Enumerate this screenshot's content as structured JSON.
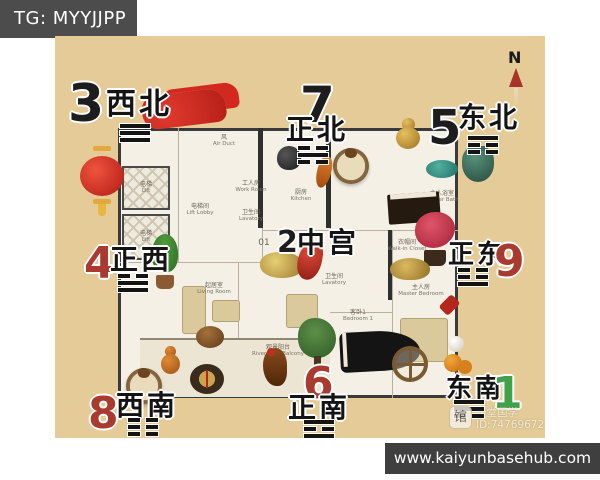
{
  "header": {
    "tag_label": "TG: MYYJJPP"
  },
  "footer": {
    "url": "www.kaiyunbasehub.com"
  },
  "watermark": {
    "icon_glyph": "馆",
    "brand": "一堂国学",
    "id": "ID:74769672"
  },
  "compass": {
    "label": "N"
  },
  "colors": {
    "background_tan": "#e5cb97",
    "banner_dark": "#4c4c4c",
    "number_black": "#1d1d1d",
    "number_red": "#a93a30",
    "number_green": "#3fa24b",
    "compass_red": "#a83226"
  },
  "sectors": {
    "nw": {
      "number": "3",
      "direction": "西北",
      "trigram_glyph": "☰",
      "trigram_lines": [
        "solid",
        "solid",
        "solid"
      ]
    },
    "n": {
      "number": "7",
      "direction": "正北",
      "trigram_glyph": "☵",
      "trigram_lines": [
        "broken",
        "solid",
        "broken"
      ]
    },
    "ne": {
      "number": "5",
      "direction": "东北",
      "trigram_glyph": "☶",
      "trigram_lines": [
        "solid",
        "broken",
        "broken"
      ]
    },
    "w": {
      "number": "4",
      "direction": "正西",
      "trigram_glyph": "☱",
      "trigram_lines": [
        "broken",
        "solid",
        "solid"
      ]
    },
    "center": {
      "number": "2",
      "direction": "中宫",
      "trigram_glyph": "",
      "trigram_lines": []
    },
    "e": {
      "number": "9",
      "direction": "正东",
      "trigram_glyph": "☳",
      "trigram_lines": [
        "broken",
        "broken",
        "solid"
      ]
    },
    "sw": {
      "number": "8",
      "direction": "西南",
      "trigram_glyph": "☷",
      "trigram_lines": [
        "broken",
        "broken",
        "broken"
      ]
    },
    "s": {
      "number": "6",
      "direction": "正南",
      "trigram_glyph": "☲",
      "trigram_lines": [
        "solid",
        "broken",
        "solid"
      ]
    },
    "se": {
      "number": "1",
      "direction": "东南",
      "trigram_glyph": "☴",
      "trigram_lines": [
        "solid",
        "solid",
        "broken"
      ]
    }
  },
  "floorplan": {
    "unit_number": "01",
    "rooms": {
      "air_duct": {
        "cn": "风",
        "en": "Air Duct"
      },
      "lift1": {
        "cn": "电梯",
        "en": "Lift"
      },
      "lift2": {
        "cn": "电梯",
        "en": "Lift"
      },
      "lift_lobby": {
        "cn": "电梯间",
        "en": "Lift Lobby"
      },
      "work_room": {
        "cn": "工人房",
        "en": "Work Room"
      },
      "lavatory1": {
        "cn": "卫生间",
        "en": "Lavatory"
      },
      "kitchen": {
        "cn": "厨房",
        "en": "Kitchen"
      },
      "bedroom2": {
        "cn": "客卧2",
        "en": "Bedroom 2"
      },
      "master_bath": {
        "cn": "主人浴室",
        "en": "Master Bath"
      },
      "dining": {
        "cn": "餐厅",
        "en": "Dining"
      },
      "lavatory2": {
        "cn": "卫生间",
        "en": "Lavatory"
      },
      "walk_in": {
        "cn": "衣帽间",
        "en": "Walk-in Closet"
      },
      "living": {
        "cn": "起居室",
        "en": "Living Room"
      },
      "bedroom1": {
        "cn": "客卧1",
        "en": "Bedroom 1"
      },
      "master_bedroom": {
        "cn": "主人房",
        "en": "Master Bedroom"
      },
      "balcony": {
        "cn": "观景阳台",
        "en": "River-view Balcony"
      }
    }
  },
  "decor_icons": [
    "red-silk-cloth-icon",
    "red-lantern-icon",
    "potted-plant-icon",
    "horse-plate-icon",
    "black-teapot-icon",
    "orange-koi-icon",
    "golden-gourd-icon",
    "upright-piano-icon",
    "jade-ornament-icon",
    "bronze-pot-icon",
    "red-bonsai-icon",
    "gold-ingots-icon",
    "red-dragon-icon",
    "golden-toad-icon",
    "red-knot-icon",
    "green-tree-icon",
    "grand-piano-icon",
    "rooster-icon",
    "horse-plate-2-icon",
    "orange-gourd-icon",
    "luopan-compass-icon",
    "brown-pot-icon",
    "dharma-wheel-icon",
    "orange-fruits-icon",
    "white-ball-icon"
  ]
}
